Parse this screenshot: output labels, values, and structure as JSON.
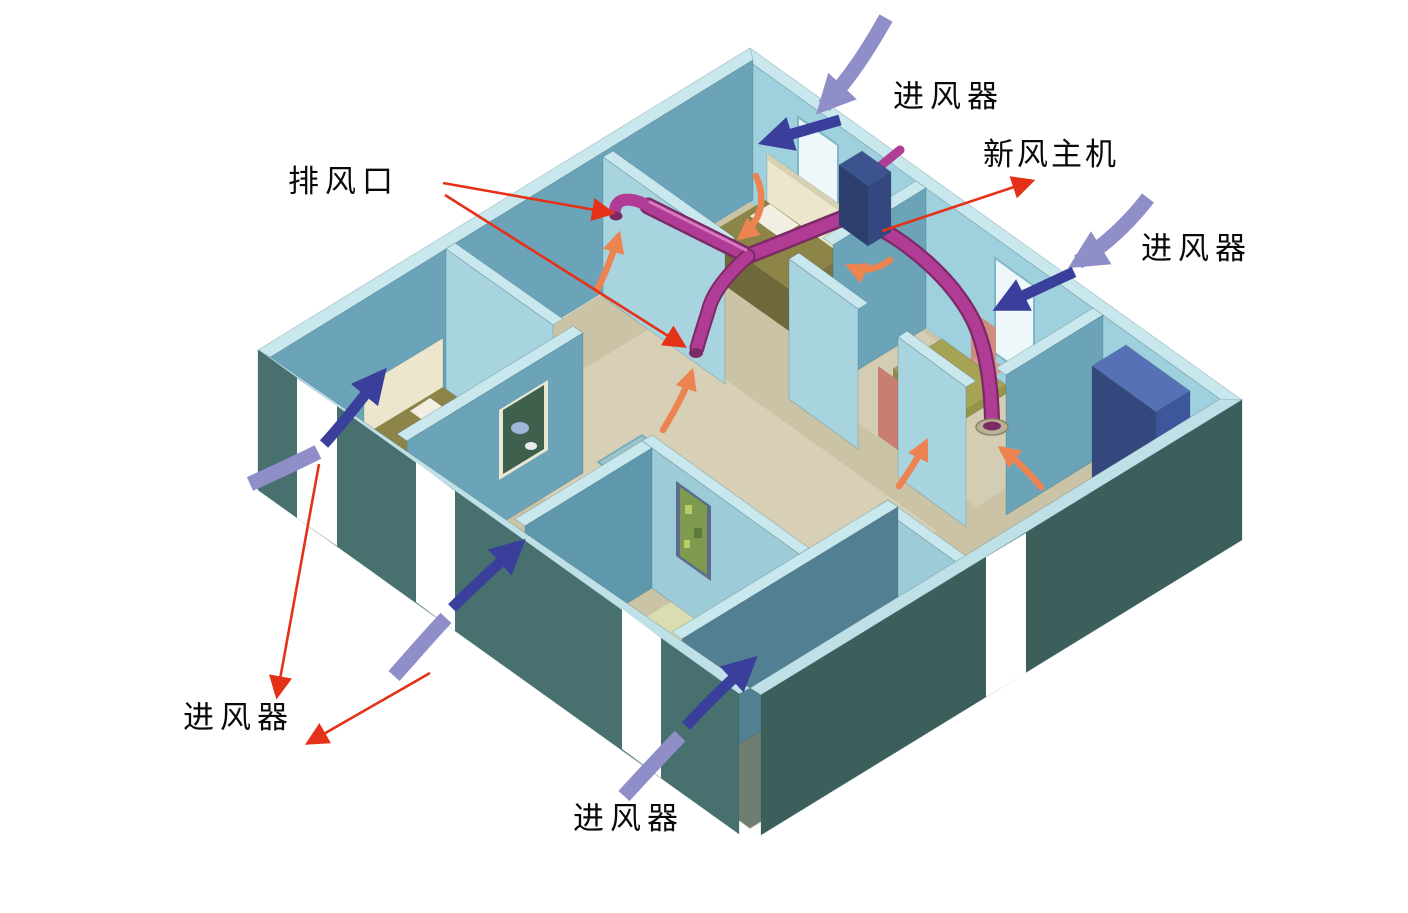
{
  "diagram": {
    "type": "isometric-cutaway-ventilation-diagram",
    "subject": "home fresh-air ventilation system"
  },
  "labels": {
    "exhaust_outlet": "排风口",
    "fresh_air_unit": "新风主机",
    "inlet_top": "进风器",
    "inlet_right": "进风器",
    "inlet_bottom_left": "进风器",
    "inlet_bottom_center": "进风器"
  },
  "colors": {
    "duct": "#b13c95",
    "duct_dark": "#7c2a66",
    "duct_light": "#d977c2",
    "unit_navy": "#2c3d6e",
    "inlet_arrow": "#8f8ec9",
    "indoor_arrow": "#3a3f9c",
    "exhaust_flow": "#ee8352",
    "annotation": "#e63119",
    "wall_light": "#a8d4e0",
    "wall_teal": "#6ba4b8",
    "wall_pale_top": "#c9e8ee",
    "wall_dark": "#3c5f5c",
    "wall_dark_sw": "#47706f",
    "floor_tan": "#cbc3a6",
    "background": "#ffffff",
    "text": "#0a0a0a"
  }
}
